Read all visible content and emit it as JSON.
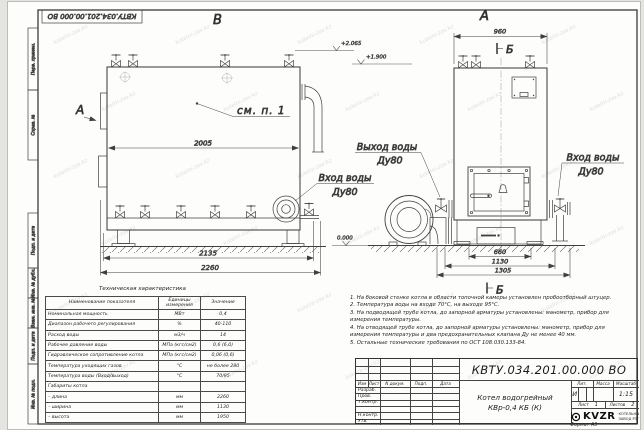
{
  "stamp_top": "КВТУ.034.201.00.000 ВО",
  "frame": {
    "strip_labels": [
      "Перв. примен.",
      "Справ. №",
      "Подп. и дата",
      "Инв. № дубл.",
      "Взам. инв. №",
      "Подп. и дата",
      "Инв. № подл."
    ],
    "format_label": "Формат  А3"
  },
  "views": {
    "left_view_label": "В",
    "left_direction_label": "А",
    "right_view_label": "А",
    "section_marker_top": "Б",
    "section_marker_bottom": "Б",
    "callout": "см. п. 1",
    "labels": {
      "outlet_line1": "Выход воды",
      "outlet_line2": "Ду80",
      "inlet_left_line1": "Вход воды",
      "inlet_left_line2": "Ду80",
      "inlet_right_line1": "Вход воды",
      "inlet_right_line2": "Ду80"
    },
    "elevations": {
      "top": "+2.065",
      "mid": "+1.900",
      "zero": "0.000"
    },
    "dims": {
      "d2005": "2005",
      "d2135": "2135",
      "d2260": "2260",
      "d960": "960",
      "d660": "660",
      "d1130": "1130",
      "d1305": "1305"
    }
  },
  "tech_table": {
    "title": "Техническая характеристика",
    "headers": [
      "Наименование показателя",
      "Единицы измерения",
      "Значение"
    ],
    "rows": [
      [
        "Номинальная мощность",
        "МВт",
        "0,4"
      ],
      [
        "Диапазон рабочего регулирования",
        "%",
        "40-110"
      ],
      [
        "Расход воды",
        "м3/ч",
        "14"
      ],
      [
        "Рабочее давление воды",
        "МПа (кгс/см2)",
        "0,6 (6,0)"
      ],
      [
        "Гидравлическое сопротивление котла",
        "МПа (кгс/см2)",
        "0,06 (0,6)"
      ],
      [
        "Температура уходящих газов",
        "°С",
        "не более 280"
      ],
      [
        "Температура воды (Вход/выход)",
        "°С",
        "70/95"
      ],
      [
        "Габариты котла",
        "",
        ""
      ],
      [
        "– длина",
        "мм",
        "2260"
      ],
      [
        "– ширина",
        "мм",
        "1130"
      ],
      [
        "– высота",
        "мм",
        "1950"
      ]
    ]
  },
  "notes": {
    "lines": [
      "1. На боковой стенке котла в области топочной камеры установлен пробоотборный штуцер.",
      "2. Температура воды на входе 70°С, на выходе 95°С.",
      "3. На подводящей трубе котла, до запорной арматуры установлены: манометр, прибор для",
      "измерения температуры.",
      "4. На отводящей трубе котла, до запорной арматуры установлены: манометр, прибор для",
      "измерения температуры и два предохранительных клапана Ду не менее 40 мм.",
      "5. Остальные технические требования по ОСТ 108.030.133-84."
    ]
  },
  "title_block": {
    "designation": "КВТУ.034.201.00.000  ВО",
    "rev_headers": [
      "Изм",
      "Лист",
      "N докум.",
      "Подп.",
      "Дата"
    ],
    "sign_rows": [
      "Разраб.",
      "Пров.",
      "Т.контр.",
      "",
      "Н.контр.",
      "Утв."
    ],
    "doc_title_line1": "Котел водогрейный",
    "doc_title_line2": "КВр-0,4  КБ  (К)",
    "lit_header": "Лит.",
    "mass_header": "Масса",
    "scale_header": "Масштаб",
    "lit_value": "И",
    "scale_value": "1:15",
    "sheet_label": "Лист",
    "sheet_value": "1",
    "sheets_label": "Листов",
    "sheets_value": "2",
    "company": {
      "logo": "KVZR",
      "line1": "КОТЕЛЬНЫЙ",
      "line2": "ЗАВОД РЭП"
    }
  },
  "watermark": {
    "text": "kotelni-zav.kz"
  }
}
